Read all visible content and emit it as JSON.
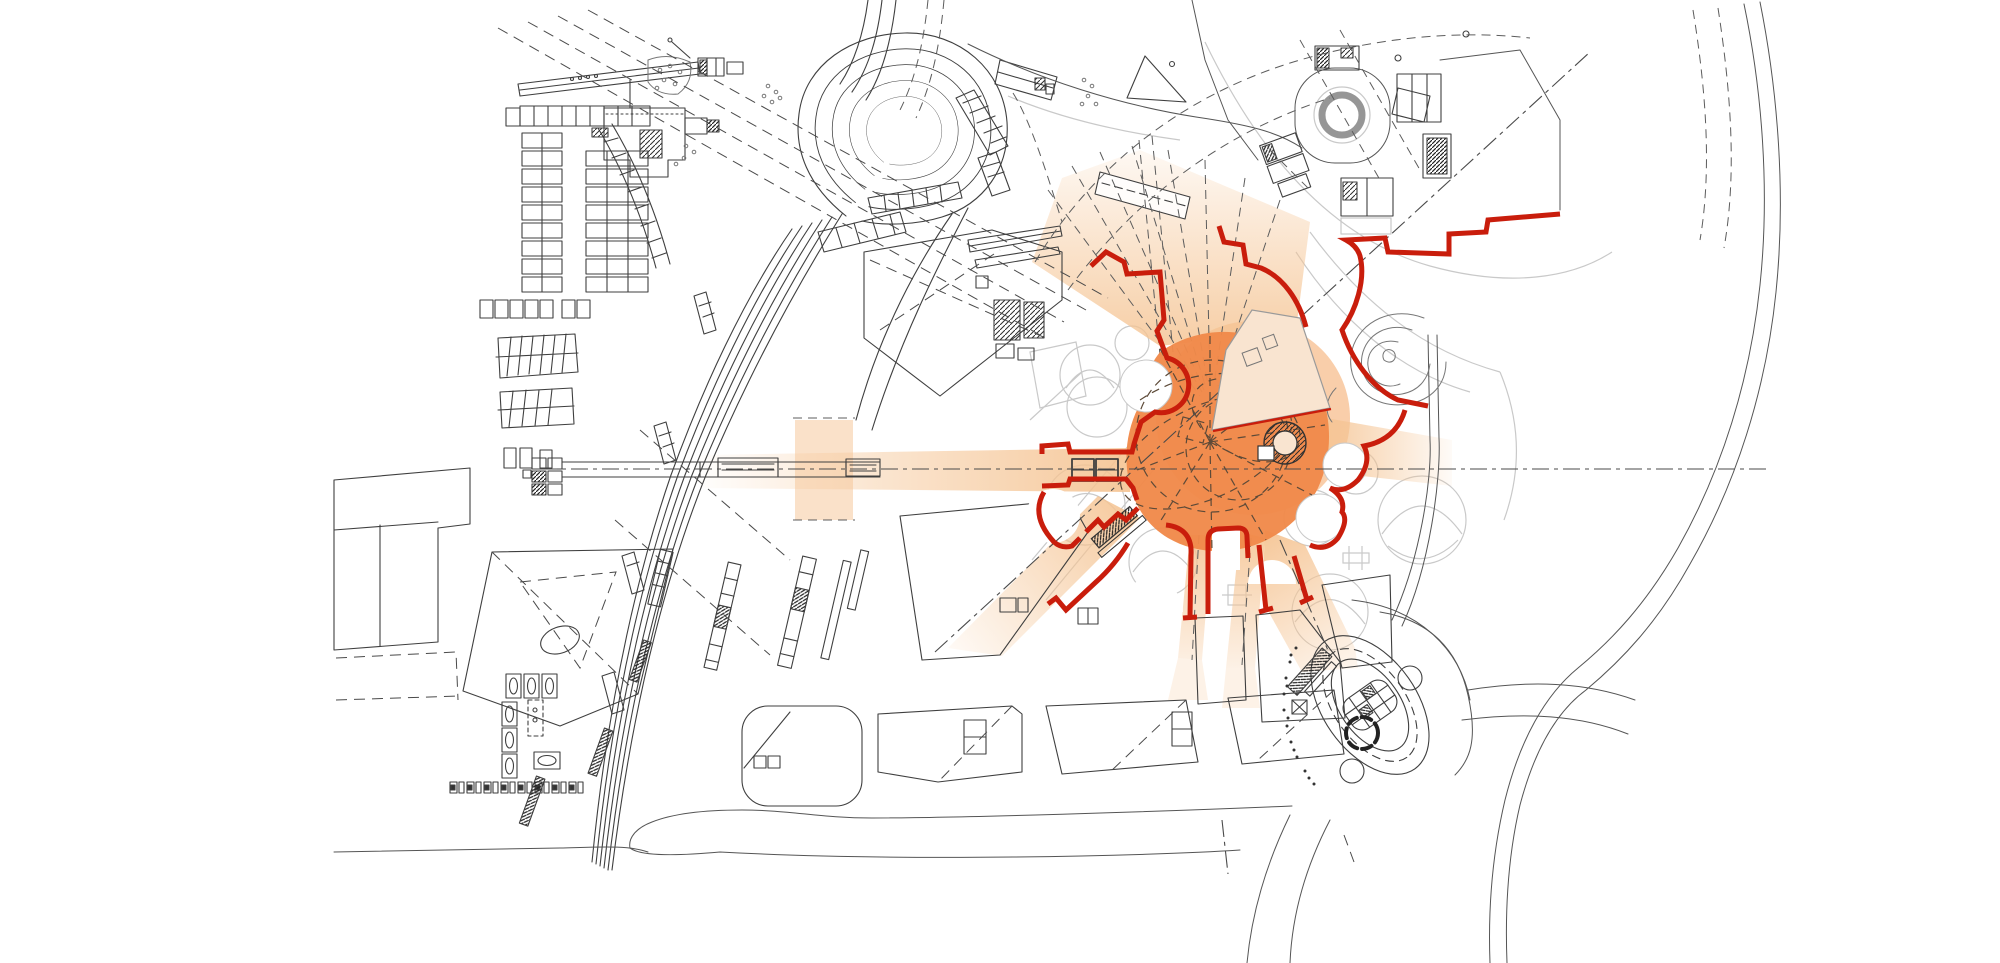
{
  "colors": {
    "background": "#ffffff",
    "boundary_red": "#c91d0c",
    "hub_orange": "#f0894a",
    "halo_peach": "#f8c9a1",
    "corridor_peach": "#f5c493",
    "slab_cream": "#f9e4d0",
    "line_dark": "#3f3f3f",
    "line_mid": "#777777",
    "line_light": "#c9c9c9"
  }
}
